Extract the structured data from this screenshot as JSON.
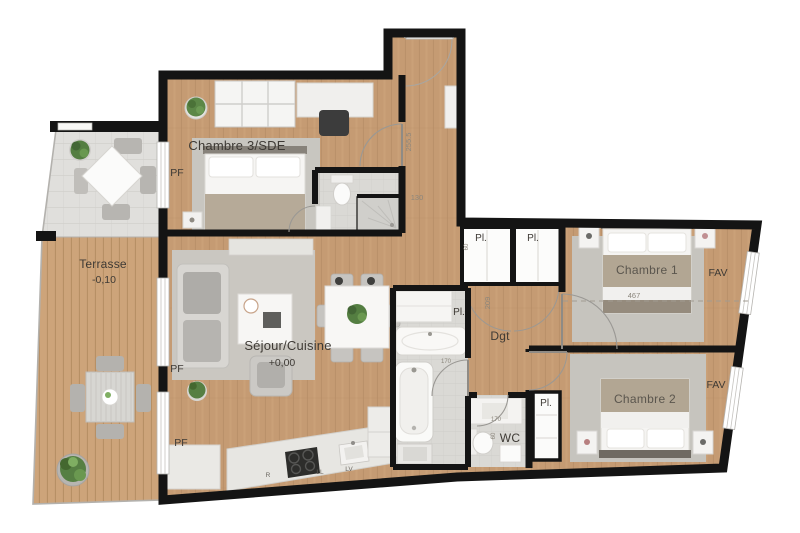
{
  "plan_type": "apartment-floor-plan",
  "rooms": {
    "chambre3": {
      "label": "Chambre 3/SDE"
    },
    "terrasse": {
      "label": "Terrasse",
      "level": "-0,10"
    },
    "sejour": {
      "label": "Séjour/Cuisine",
      "level": "+0,00"
    },
    "dgt": {
      "label": "Dgt"
    },
    "chambre1": {
      "label": "Chambre 1"
    },
    "chambre2": {
      "label": "Chambre 2"
    },
    "wc": {
      "label": "WC"
    }
  },
  "closets": {
    "hall_left": "Pl.",
    "hall_right": "Pl.",
    "bathroom": "Pl.",
    "chambre2": "Pl."
  },
  "windows": {
    "pf_chambre3": "PF",
    "pf_sejour": "PF",
    "pf_kitchen": "PF",
    "fav_chambre1": "FAV",
    "fav_chambre2": "FAV"
  },
  "dimensions": {
    "entry_length": "255.5",
    "entry_width": "130",
    "hall_closet": "60",
    "dgt_length": "209",
    "chambre1_width": "467",
    "bathroom_width": "170",
    "wc_basin": "170",
    "wc_door": "60"
  },
  "appliances": {
    "fridge": "R",
    "washing_machine": "LL",
    "dishwasher": "LV"
  },
  "colors": {
    "wall": "#141414",
    "wood": "#c59b73",
    "deck": "#cda47a",
    "wet_floor": "#dad9d5",
    "plant": "#567f43"
  }
}
